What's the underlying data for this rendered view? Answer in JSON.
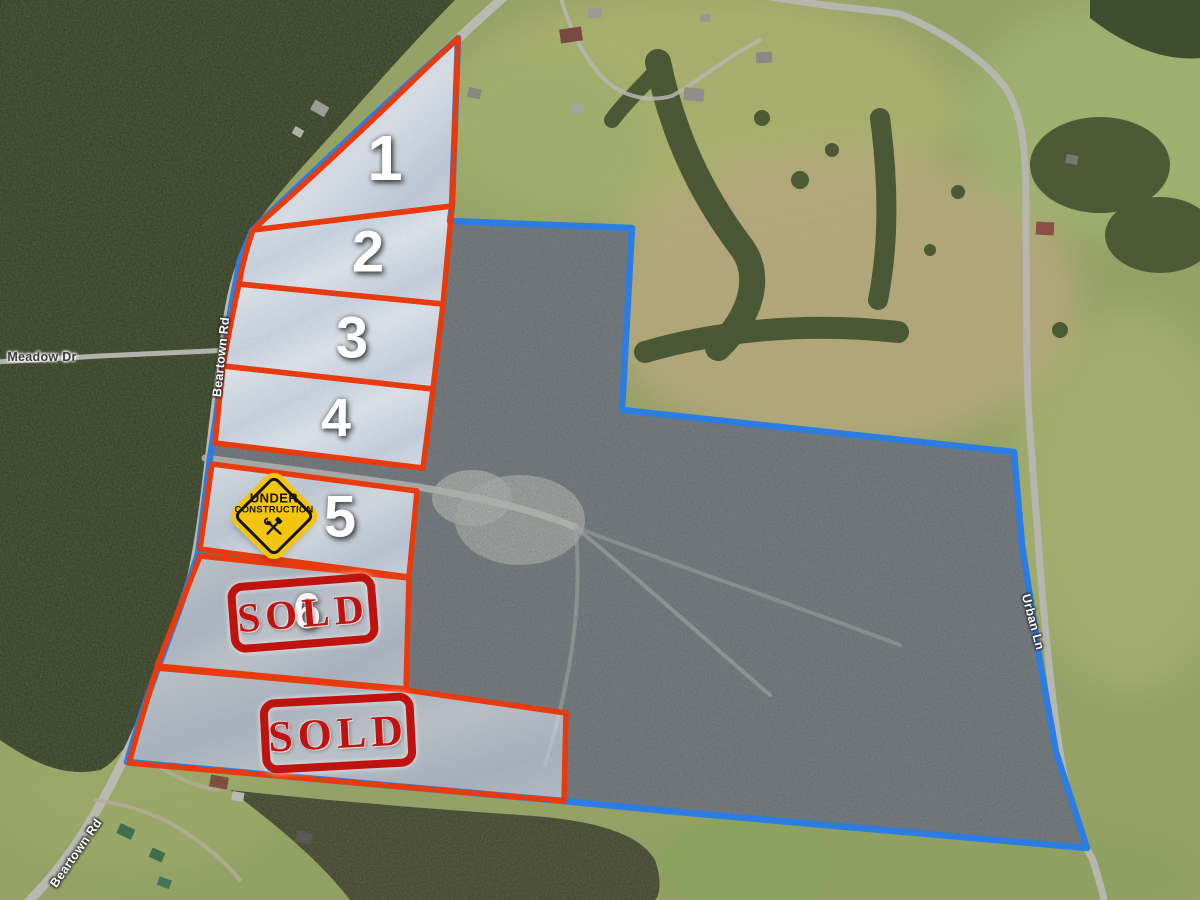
{
  "road_labels": {
    "meadow_dr": "Meadow Dr",
    "beartown_rd_upper": "Beartown Rd",
    "beartown_rd_lower": "Beartown Rd",
    "urban_ln": "Urban Ln"
  },
  "lots": [
    {
      "number": "1",
      "status": "available"
    },
    {
      "number": "2",
      "status": "available"
    },
    {
      "number": "3",
      "status": "available"
    },
    {
      "number": "4",
      "status": "available"
    },
    {
      "number": "5",
      "status": "under construction"
    },
    {
      "number": "6",
      "status": "sold"
    },
    {
      "number": "",
      "status": "sold"
    }
  ],
  "construction_sign": {
    "line1": "UNDER",
    "line2": "CONSTRUCTION"
  },
  "sold_stamps": [
    {
      "label": "SOLD"
    },
    {
      "label": "SOLD"
    }
  ],
  "colors": {
    "lot_outline_red": "#e73b0e",
    "boundary_blue": "#2b7de2",
    "sign_yellow": "#f3c50c",
    "stamp_red": "#bf1310",
    "lot_fill_light": "#dbe3ef",
    "forest_green": "#44522f",
    "scrub_brown": "#5f5a48"
  }
}
